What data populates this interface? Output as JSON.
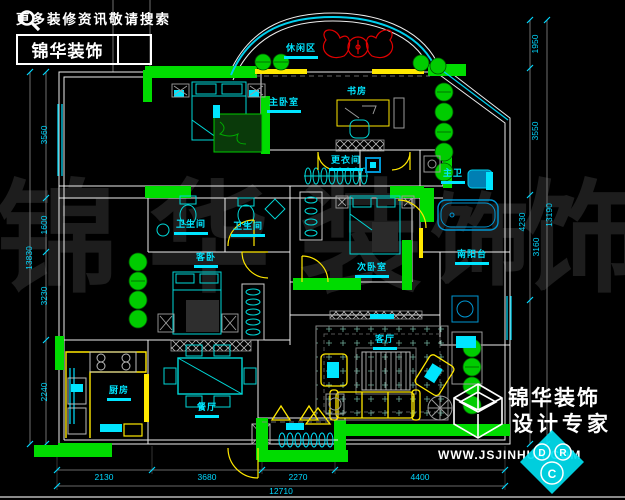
{
  "branding": {
    "tagline": "更多装修资讯敬请搜索",
    "logo_text": "锦华装饰",
    "footer": {
      "company": "锦华装饰",
      "slogan": "设计专家",
      "website": "WWW.JSJINHUA.COM"
    }
  },
  "watermark": {
    "chars": [
      "锦",
      "华",
      "装",
      "饰",
      "饰"
    ]
  },
  "compass": {
    "letters": [
      "D",
      "R",
      "C"
    ]
  },
  "rooms": {
    "leisure": "休闲区",
    "master": "主卧室",
    "study": "书房",
    "dressing": "更衣间",
    "bath1": "卫生间",
    "bath2": "卫生间",
    "guest": "客卧",
    "second": "次卧室",
    "master_bath": "主卫",
    "south_balcony": "南阳台",
    "kitchen": "厨房",
    "dining": "餐厅",
    "living": "客厅"
  },
  "dimensions": {
    "bottom": [
      "2130",
      "3680",
      "2270",
      "4400"
    ],
    "bottom_total": "12710",
    "left": [
      "3560",
      "1600",
      "3230",
      "2240"
    ],
    "left_total": "13830",
    "right": [
      "1950",
      "3550",
      "4230",
      "3160"
    ],
    "right_total": "13190"
  },
  "colors": {
    "wall_highlight": "#00dc00",
    "wall_line": "#ededed",
    "furniture": "#00d8d8",
    "label": "#00e5ff",
    "door": "#ffe800",
    "accent_red": "#e10000"
  }
}
